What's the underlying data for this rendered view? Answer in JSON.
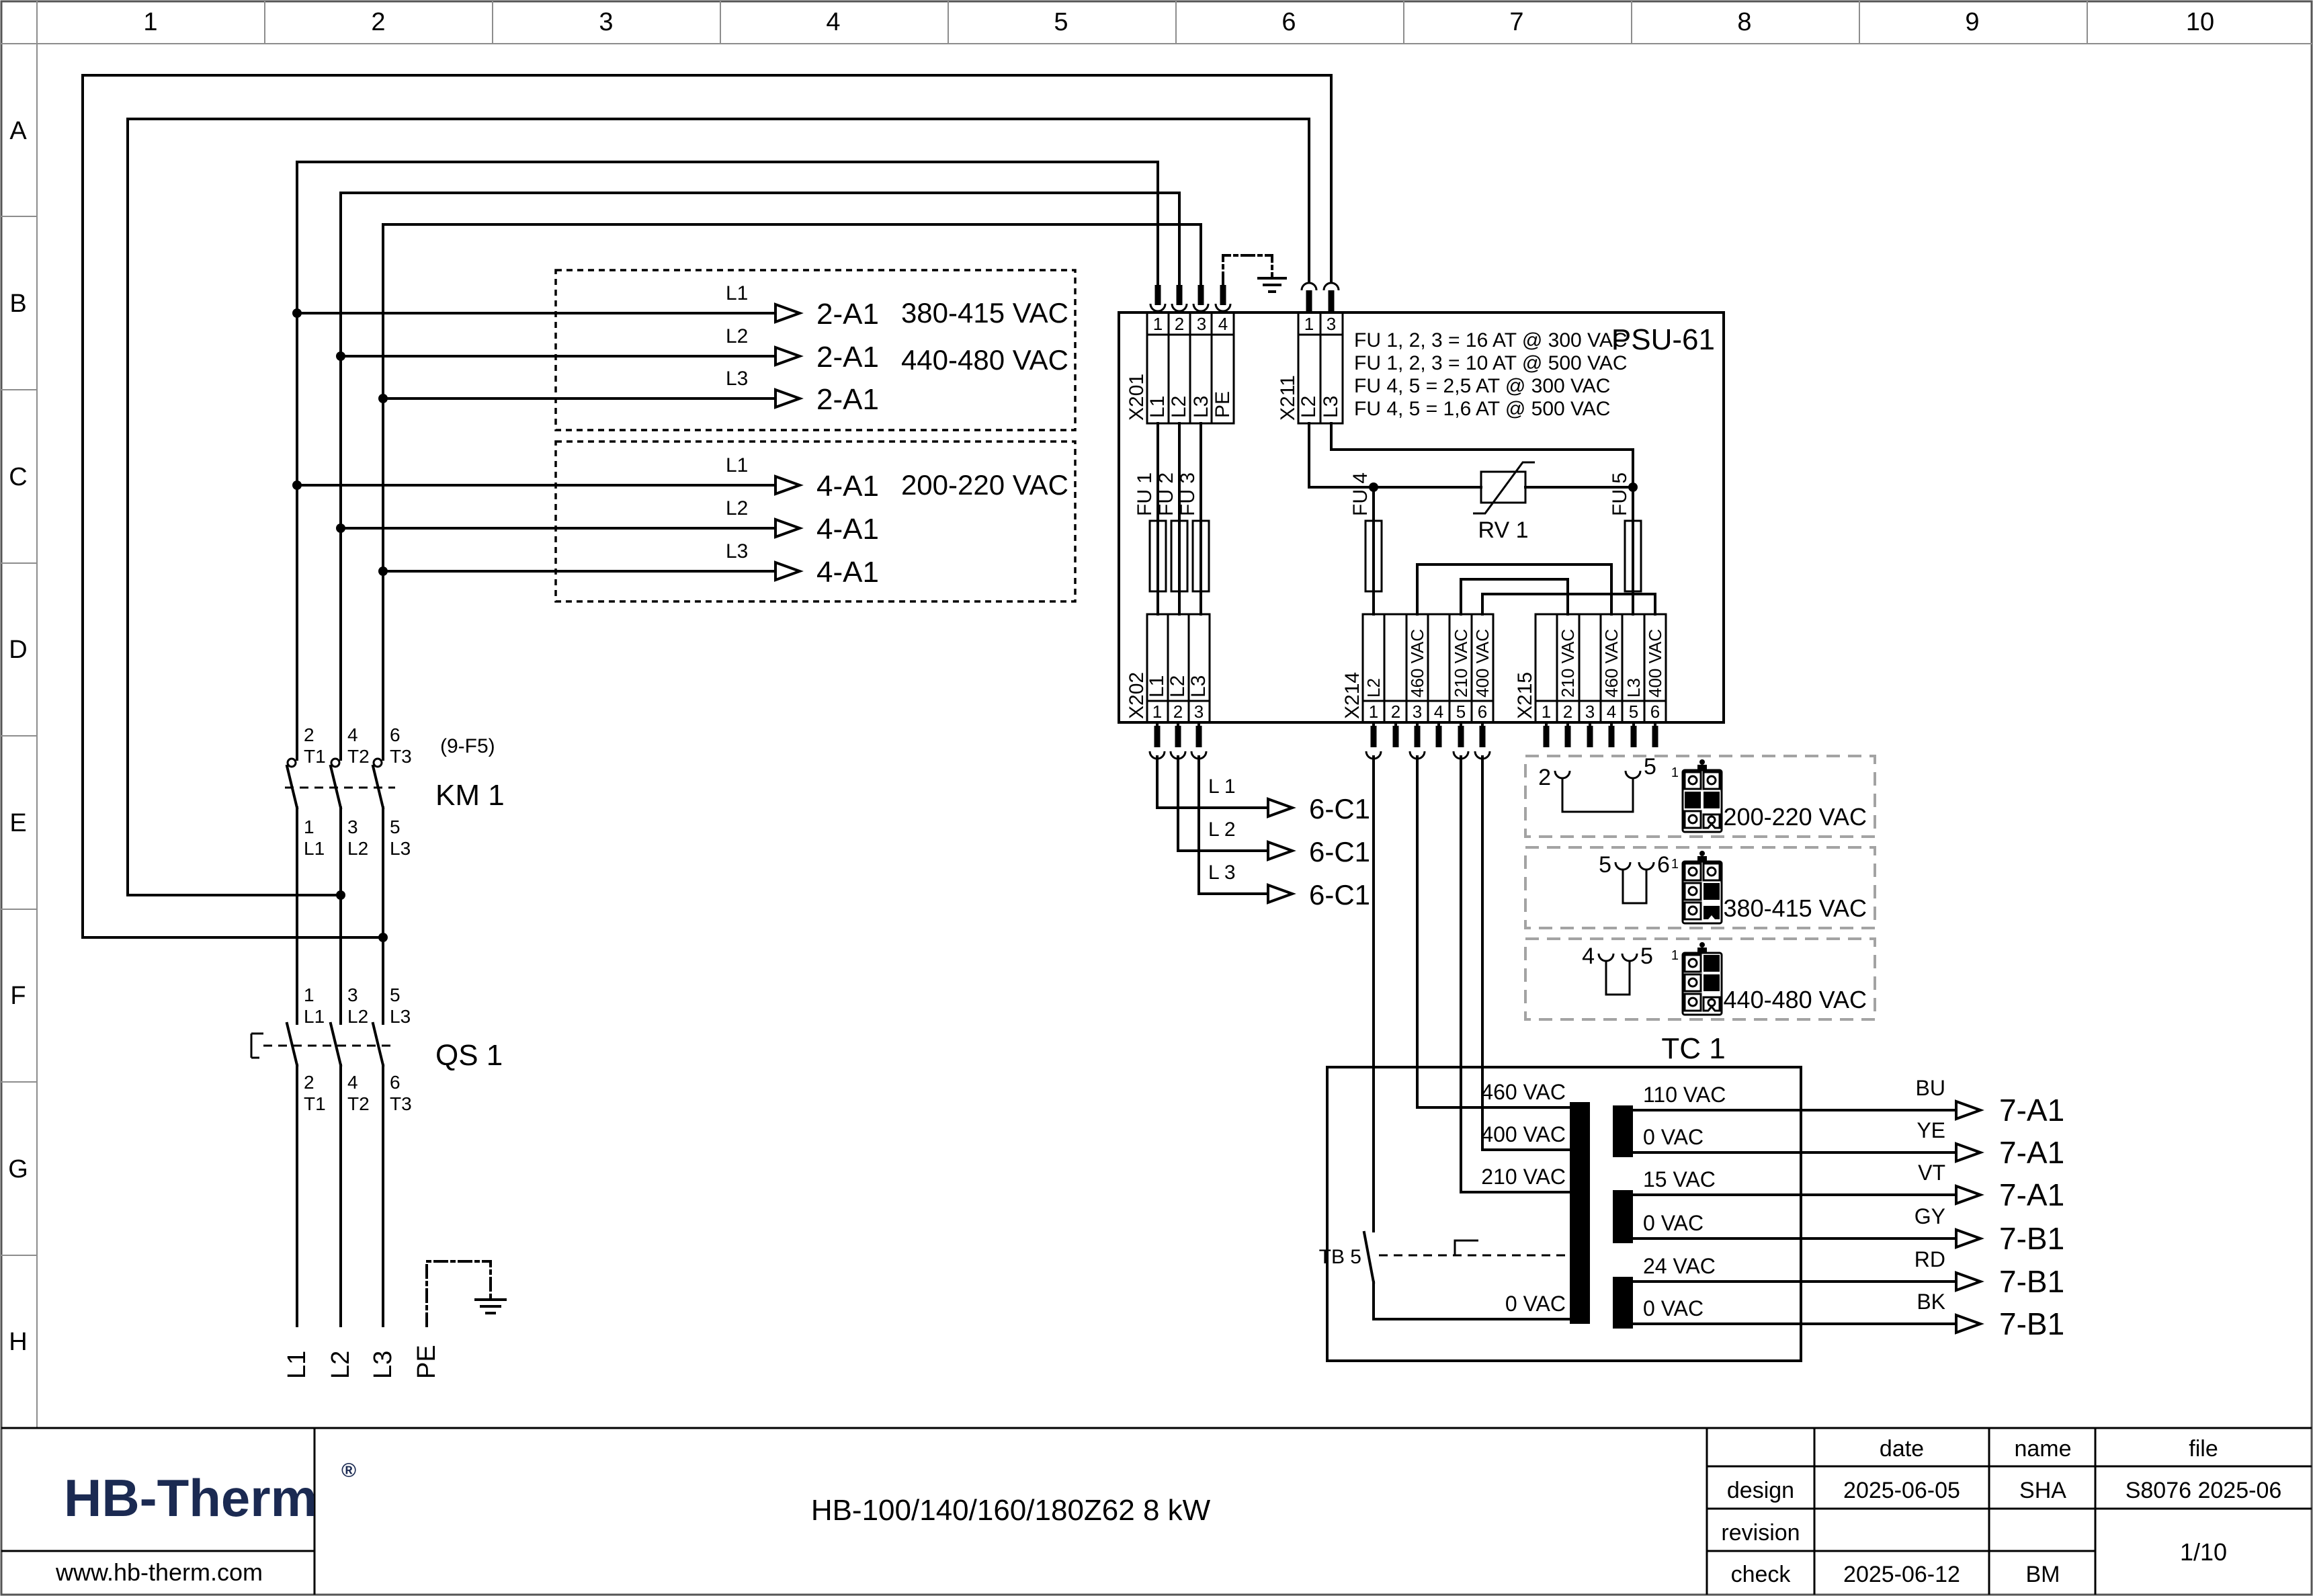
{
  "grid": {
    "columns": [
      "1",
      "2",
      "3",
      "4",
      "5",
      "6",
      "7",
      "8",
      "9",
      "10"
    ],
    "rows": [
      "A",
      "B",
      "C",
      "D",
      "E",
      "F",
      "G",
      "H"
    ]
  },
  "hv_box": {
    "l1": "L1",
    "l2": "L2",
    "l3": "L3",
    "target": "2-A1",
    "voltage1": "380-415 VAC",
    "voltage2": "440-480 VAC"
  },
  "lv_box": {
    "l1": "L1",
    "l2": "L2",
    "l3": "L3",
    "target": "4-A1",
    "voltage": "200-220 VAC"
  },
  "km1": {
    "ref": "(9-F5)",
    "label": "KM 1",
    "pins_top": [
      [
        "2",
        "T1"
      ],
      [
        "4",
        "T2"
      ],
      [
        "6",
        "T3"
      ]
    ],
    "pins_bottom": [
      [
        "1",
        "L1"
      ],
      [
        "3",
        "L2"
      ],
      [
        "5",
        "L3"
      ]
    ]
  },
  "qs1": {
    "label": "QS 1",
    "pins_top": [
      [
        "1",
        "L1"
      ],
      [
        "3",
        "L2"
      ],
      [
        "5",
        "L3"
      ]
    ],
    "pins_bottom": [
      [
        "2",
        "T1"
      ],
      [
        "4",
        "T2"
      ],
      [
        "6",
        "T3"
      ]
    ]
  },
  "mains": {
    "l1": "L1",
    "l2": "L2",
    "l3": "L3",
    "pe": "PE"
  },
  "psu": {
    "label": "PSU-61",
    "x201": {
      "name": "X201",
      "numbers": [
        "1",
        "2",
        "3",
        "4"
      ],
      "labels": [
        "L1",
        "L2",
        "L3",
        "PE"
      ]
    },
    "x211": {
      "name": "X211",
      "numbers": [
        "1",
        "3"
      ],
      "labels": [
        "L2",
        "L3"
      ]
    },
    "fuse_notes": [
      "FU 1, 2, 3 = 16 AT @ 300 VAC",
      "FU 1, 2, 3 = 10 AT @ 500 VAC",
      "FU 4, 5 = 2,5 AT @ 300 VAC",
      "FU 4, 5 = 1,6 AT @ 500 VAC"
    ],
    "fu1": "FU 1",
    "fu2": "FU 2",
    "fu3": "FU 3",
    "fu4": "FU 4",
    "fu5": "FU 5",
    "rv1": "RV 1",
    "x202": {
      "name": "X202",
      "numbers": [
        "1",
        "2",
        "3"
      ],
      "labels": [
        "L1",
        "L2",
        "L3"
      ]
    },
    "x214": {
      "name": "X214",
      "numbers": [
        "1",
        "2",
        "3",
        "4",
        "5",
        "6"
      ],
      "labels": [
        "L2",
        "",
        "460 VAC",
        "",
        "210 VAC",
        "400 VAC"
      ]
    },
    "x215": {
      "name": "X215",
      "numbers": [
        "1",
        "2",
        "3",
        "4",
        "5",
        "6"
      ],
      "labels": [
        "",
        "210 VAC",
        "",
        "460 VAC",
        "L3",
        "400 VAC"
      ]
    }
  },
  "c1_out": {
    "target": "6-C1",
    "phases": [
      "L 1",
      "L 2",
      "L 3"
    ]
  },
  "configs": [
    {
      "pin_a": "2",
      "pin_b": "5",
      "pin1": "1",
      "voltage": "200-220 VAC"
    },
    {
      "pin_a": "5",
      "pin_b": "6",
      "pin1": "1",
      "voltage": "380-415 VAC"
    },
    {
      "pin_a": "4",
      "pin_b": "5",
      "pin1": "1",
      "voltage": "440-480 VAC"
    }
  ],
  "tc1": {
    "label": "TC 1",
    "tb5": "TB 5",
    "primary": [
      "460 VAC",
      "400 VAC",
      "210 VAC",
      "0 VAC"
    ],
    "secondary": [
      "110 VAC",
      "0 VAC",
      "15 VAC",
      "0 VAC",
      "24 VAC",
      "0 VAC"
    ]
  },
  "outputs": [
    {
      "color": "BU",
      "target": "7-A1"
    },
    {
      "color": "YE",
      "target": "7-A1"
    },
    {
      "color": "VT",
      "target": "7-A1"
    },
    {
      "color": "GY",
      "target": "7-B1"
    },
    {
      "color": "RD",
      "target": "7-B1"
    },
    {
      "color": "BK",
      "target": "7-B1"
    }
  ],
  "title_block": {
    "logo": "HB-Therm",
    "reg": "®",
    "website": "www.hb-therm.com",
    "title": "HB-100/140/160/180Z62 8 kW",
    "col_date": "date",
    "col_name": "name",
    "col_file": "file",
    "row_design": "design",
    "row_revision": "revision",
    "row_check": "check",
    "design_date": "2025-06-05",
    "design_name": "SHA",
    "check_date": "2025-06-12",
    "check_name": "BM",
    "file_value": "S8076 2025-06",
    "page": "1/10"
  },
  "colors": {
    "line": "#000000",
    "logo": "#1b2a52",
    "grid_line": "#8d8d8d",
    "config_dash": "#a3a3a3"
  }
}
